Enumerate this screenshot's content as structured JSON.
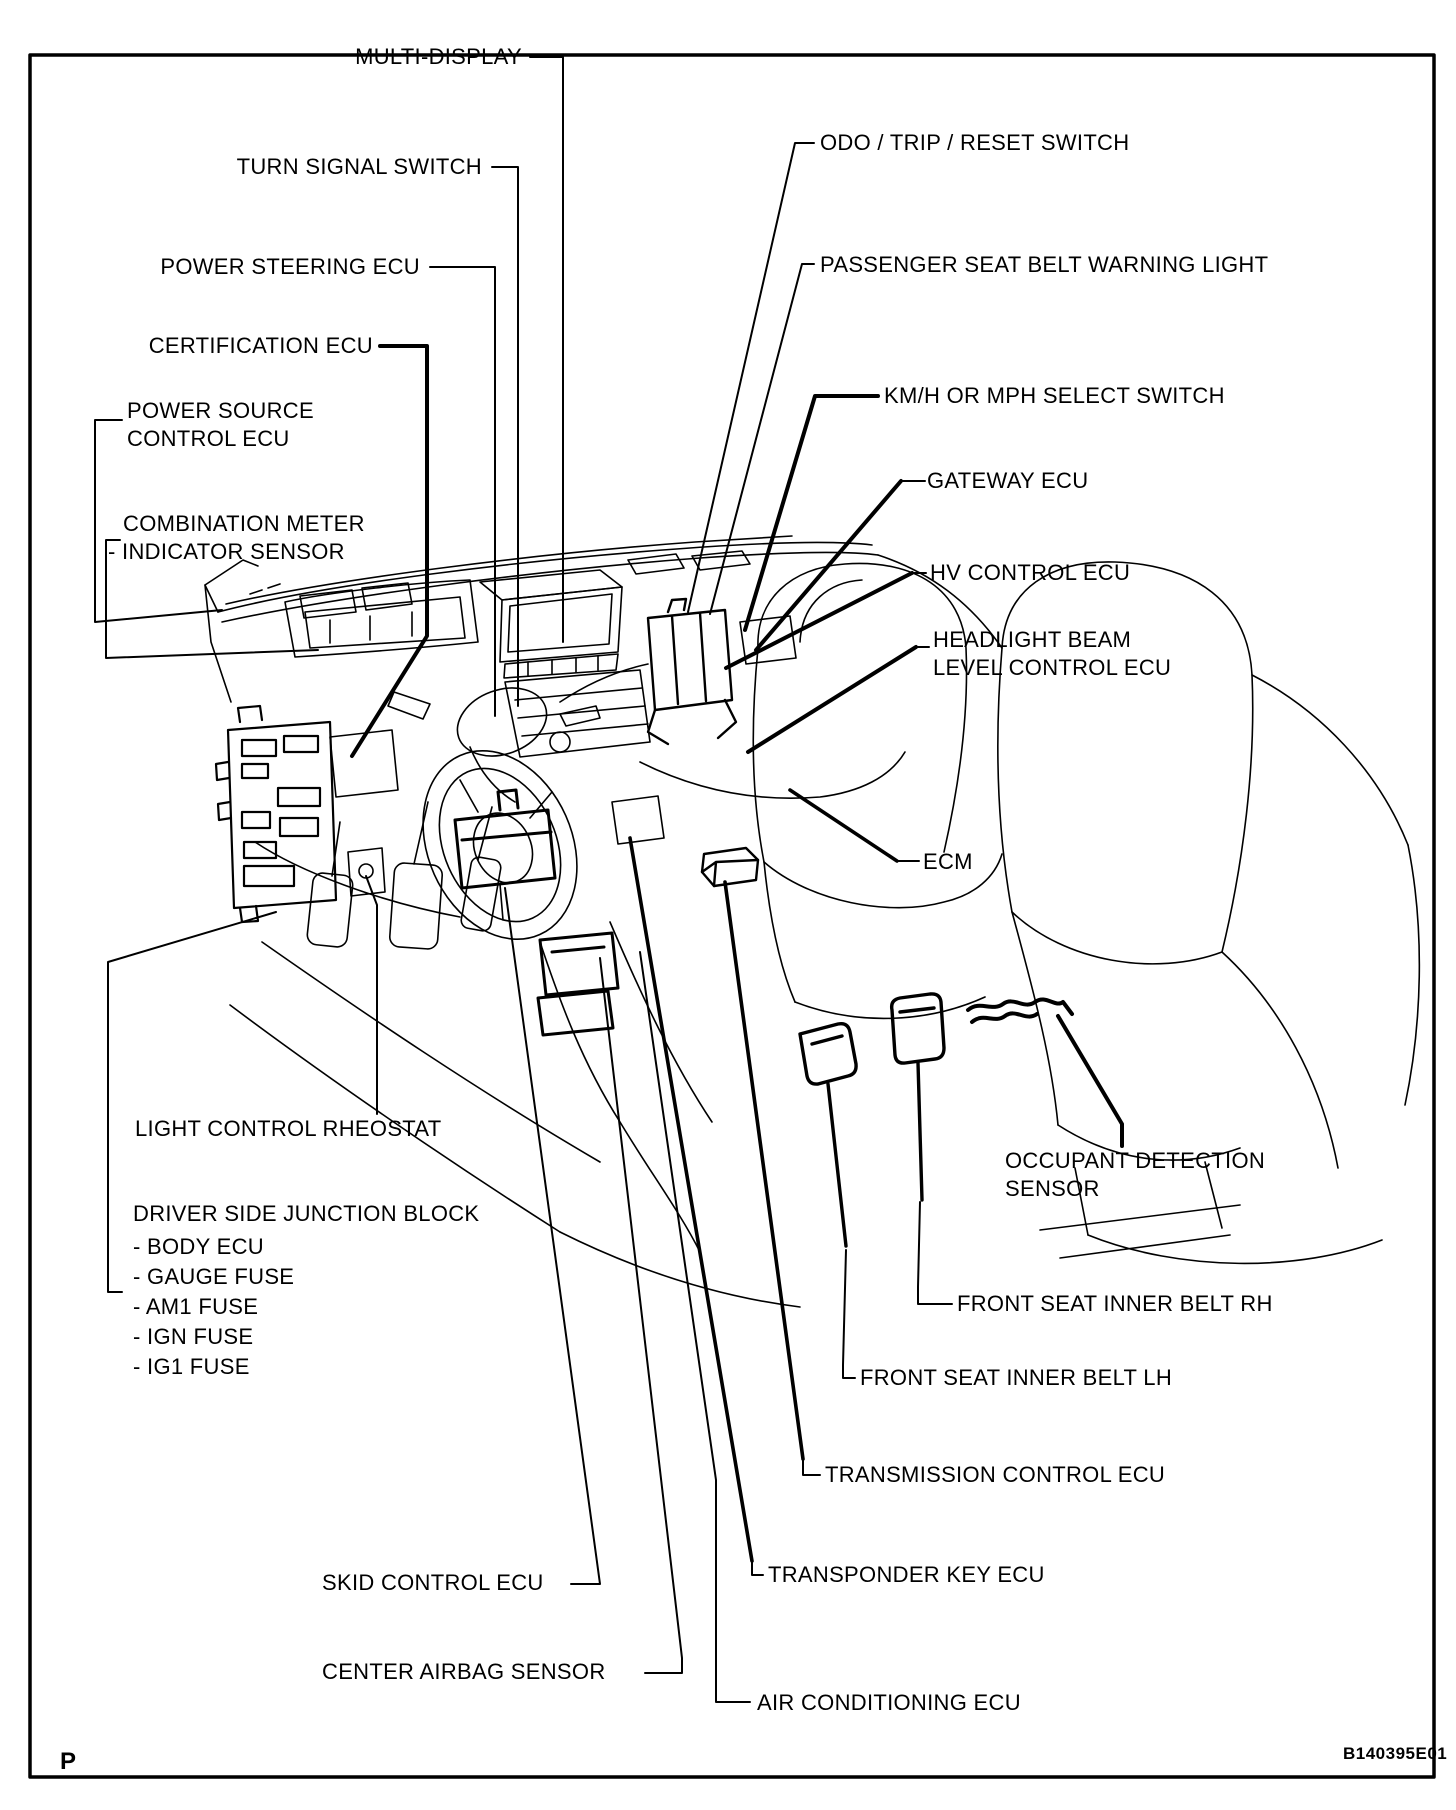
{
  "figure": {
    "page_marker": "P",
    "figure_code": "B140395E01"
  },
  "colors": {
    "ink": "#000000",
    "paper": "#ffffff"
  },
  "labels": {
    "multi_display": "MULTI-DISPLAY",
    "turn_signal_switch": "TURN SIGNAL SWITCH",
    "power_steering_ecu": "POWER STEERING ECU",
    "certification_ecu": "CERTIFICATION ECU",
    "power_source_control_ecu_line1": "POWER SOURCE",
    "power_source_control_ecu_line2": "CONTROL ECU",
    "combination_meter_line1": "COMBINATION METER",
    "combination_meter_line2": "- INDICATOR SENSOR",
    "odo_trip_reset_switch": "ODO / TRIP / RESET SWITCH",
    "passenger_seat_belt_warning_light": "PASSENGER SEAT BELT WARNING LIGHT",
    "kmh_mph_select_switch": "KM/H OR MPH SELECT SWITCH",
    "gateway_ecu": "GATEWAY ECU",
    "hv_control_ecu": "HV CONTROL ECU",
    "headlight_beam_line1": "HEADLIGHT BEAM",
    "headlight_beam_line2": "LEVEL CONTROL ECU",
    "ecm": "ECM",
    "light_control_rheostat": "LIGHT CONTROL RHEOSTAT",
    "driver_side_junction_block": "DRIVER SIDE JUNCTION BLOCK",
    "junction_block_items": [
      "- BODY ECU",
      "- GAUGE FUSE",
      "- AM1 FUSE",
      "- IGN FUSE",
      "- IG1 FUSE"
    ],
    "occupant_detection_sensor_line1": "OCCUPANT DETECTION",
    "occupant_detection_sensor_line2": "SENSOR",
    "front_seat_inner_belt_rh": "FRONT SEAT INNER BELT RH",
    "front_seat_inner_belt_lh": "FRONT SEAT INNER BELT LH",
    "transmission_control_ecu": "TRANSMISSION CONTROL ECU",
    "transponder_key_ecu": "TRANSPONDER KEY ECU",
    "skid_control_ecu": "SKID CONTROL ECU",
    "center_airbag_sensor": "CENTER AIRBAG SENSOR",
    "air_conditioning_ecu": "AIR CONDITIONING ECU"
  }
}
